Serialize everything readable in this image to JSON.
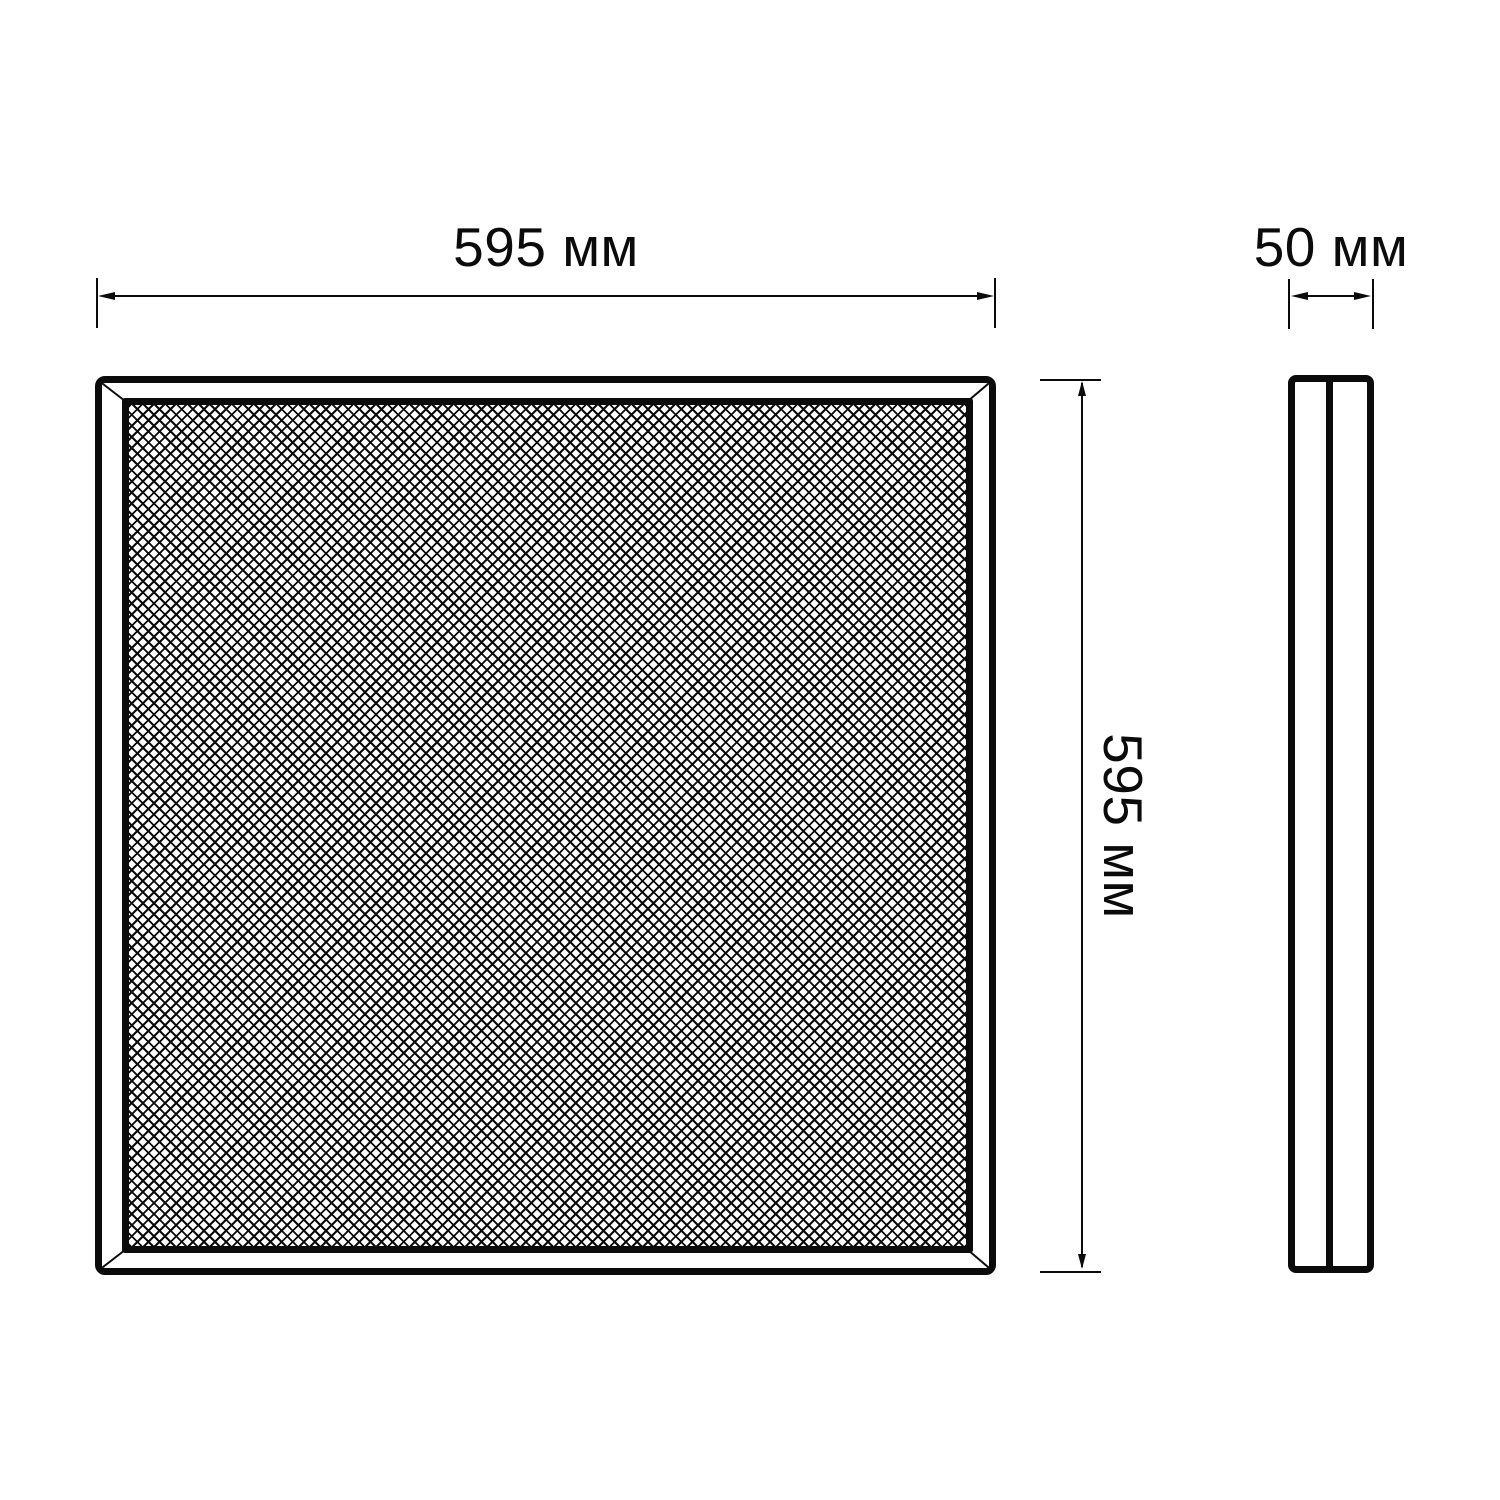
{
  "dimensions": {
    "front_width": {
      "label": "595 мм"
    },
    "front_height": {
      "label": "595 мм"
    },
    "panel_depth": {
      "label": "50 мм"
    }
  },
  "colors": {
    "line": "#0b0b0b",
    "background": "#ffffff"
  }
}
